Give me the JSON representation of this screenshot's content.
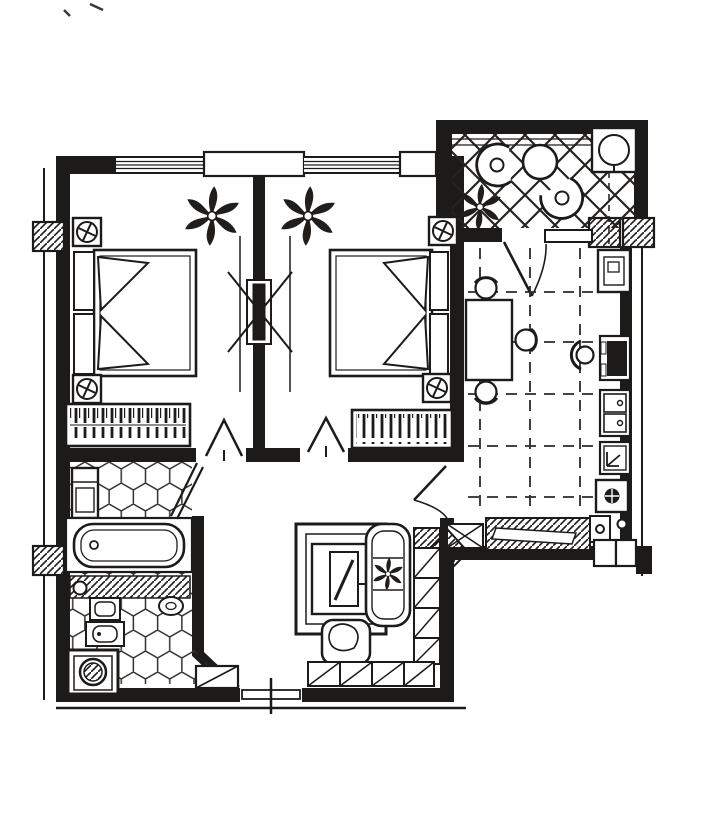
{
  "page": {
    "kind": "scanned black-and-white architectural floor plan of an apartment",
    "background_color": "#ffffff",
    "line_color": "#1d1b1a",
    "visible_text": "none"
  },
  "rooms": {
    "bedroom_left": {
      "name": "bedroom-left",
      "floor": "plain",
      "furniture": [
        "double-bed",
        "headboard-panels",
        "pillow-wedges",
        "wardrobe-with-hangers",
        "potted-plant",
        "column-marker",
        "column-marker",
        "swing-door"
      ]
    },
    "bedroom_right": {
      "name": "bedroom-right",
      "floor": "plain",
      "furniture": [
        "double-bed",
        "headboard-panels",
        "pillow-wedges",
        "wardrobe-with-hangers",
        "potted-plant",
        "column-marker",
        "column-marker",
        "swing-door",
        "partition-cabinet-with-x"
      ]
    },
    "balcony": {
      "name": "balcony-loggia",
      "floor": "diagonal-lattice-tiles",
      "furniture": [
        "tub-chair",
        "tub-chair",
        "round-table",
        "corner-table-with-lamp",
        "potted-plant",
        "balcony-door"
      ]
    },
    "kitchen_dining": {
      "name": "kitchen-dining",
      "floor": "dashed-tile-grid",
      "furniture": [
        "dining-table",
        "chair",
        "chair",
        "chair",
        "counter-stool",
        "refrigerator",
        "cooktop",
        "double-sink",
        "dishwasher",
        "round-hob-appliance",
        "hatched-radiator-window-band",
        "entry-door"
      ]
    },
    "bathroom": {
      "name": "bathroom",
      "floor": "hexagonal-tiles",
      "furniture": [
        "tall-cabinet",
        "bathtub",
        "hatched-vanity-counter",
        "washbasin",
        "pedestal-basin",
        "toilet",
        "washing-machine",
        "swing-door"
      ]
    },
    "living_room": {
      "name": "living-room",
      "floor": "plain",
      "furniture": [
        "tv-cabinet",
        "television",
        "sofa",
        "plant-on-sofa",
        "armchair",
        "shelving-column",
        "low-cabinet-row",
        "shoe-cabinet",
        "entrance-door",
        "threshold-hatch"
      ]
    },
    "hallway": {
      "name": "hallway",
      "floor": "plain",
      "furniture": []
    }
  },
  "symbols": {
    "column_marker": "square with circled rotated cross",
    "wall_section": "diagonal hatching",
    "door": "leaf line with swing arc",
    "window": "band of parallel thin lines",
    "wardrobe": "box filled with vertical hanger strokes"
  }
}
